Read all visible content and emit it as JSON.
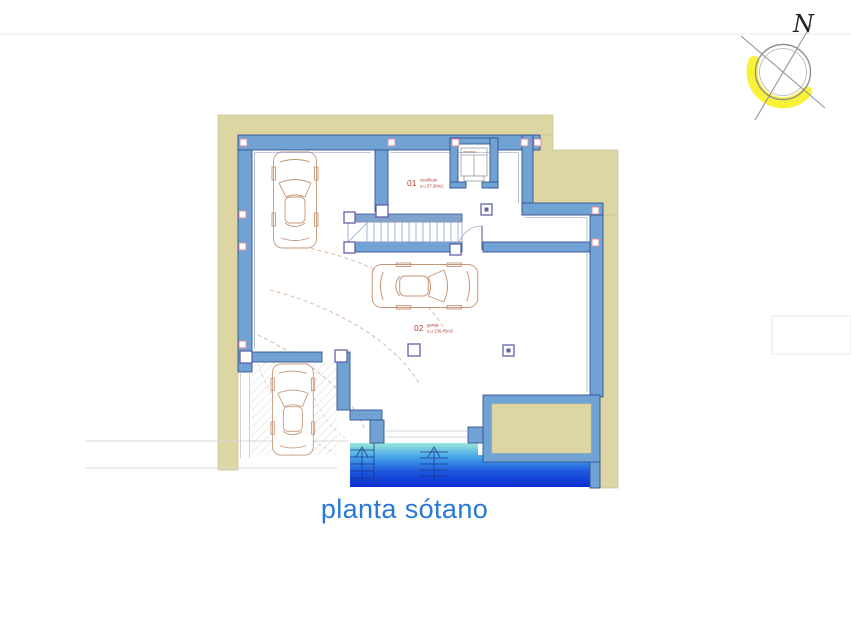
{
  "sheet": {
    "title": "planta sótano",
    "title_color": "#2878d8"
  },
  "compass": {
    "north_label": "N",
    "glow_color": "#f8f239"
  },
  "plan": {
    "rooms": [
      {
        "number": "01",
        "name": "vestíbulo",
        "area": "s.u 37,30m2"
      },
      {
        "number": "02",
        "name": "garaje",
        "area": "s.u 136,45m2"
      }
    ],
    "elevator_label": "ascensor",
    "colors": {
      "wall_fill": "#71a2d4",
      "wall_outline": "#34548e",
      "insulation_band": "#ddd5a2",
      "column_outline": "#6060ad",
      "window_marker": "#dd8fa0",
      "car_outline": "#c69576",
      "room_label_red": "#b5403c",
      "ramp_gradient_top": "#9ae8d8",
      "ramp_gradient_bottom": "#0b2ed2",
      "hatch_gray": "#d6d6d6"
    }
  }
}
